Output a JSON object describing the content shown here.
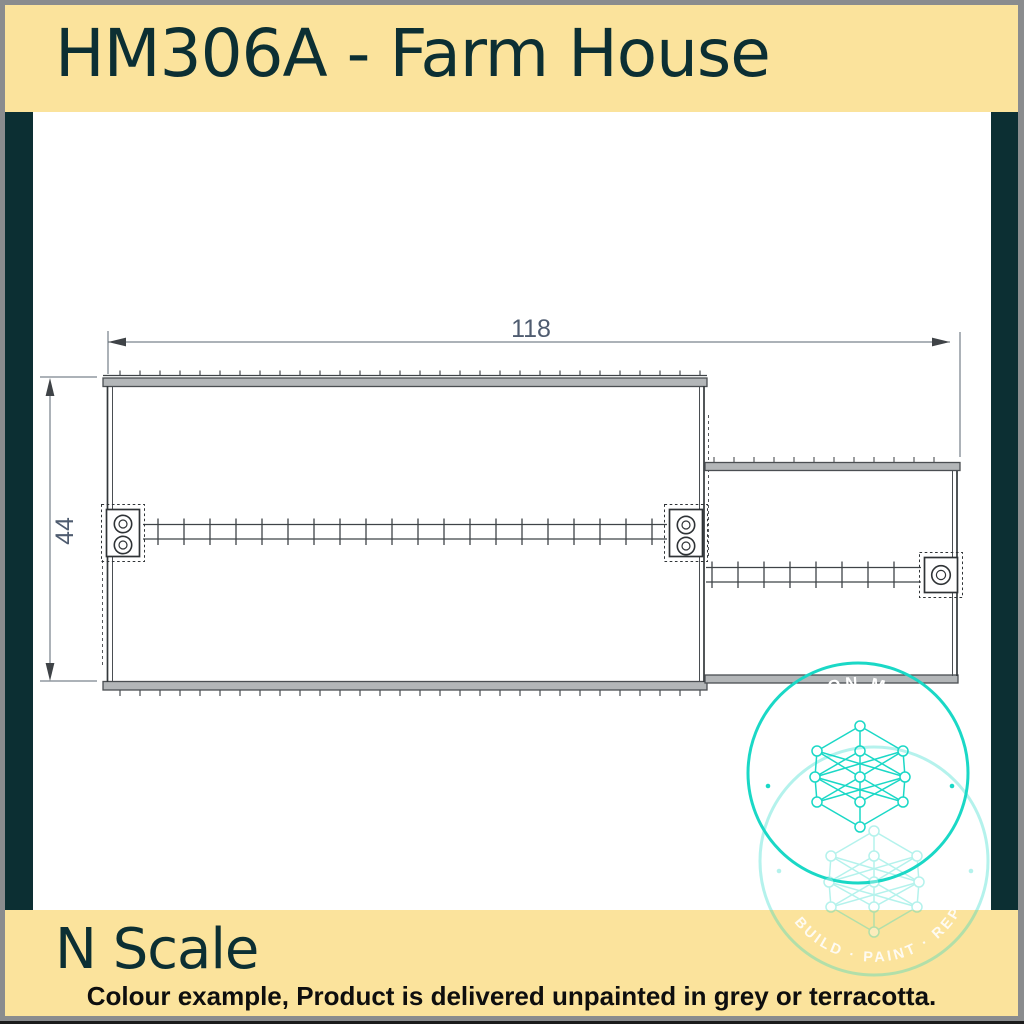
{
  "header": {
    "title": "HM306A - Farm House"
  },
  "footer": {
    "scale_label": "N Scale",
    "caption": "Colour example, Product is delivered unpainted in grey or terracotta."
  },
  "drawing": {
    "dim_width": "118",
    "dim_height": "44"
  },
  "watermark": {
    "arc_text_top": "ON M",
    "arc_text_bottom": "· BUILD · PAINT · REP"
  },
  "colors": {
    "banner_yellow": "#FBE39C",
    "accent_teal_dark": "#0C2F33",
    "frame_gray": "#8A8C8E",
    "watermark_teal": "#1AD8C6",
    "dimension_text": "#4F5C70",
    "drawing_line": "#3F4347",
    "caption_text": "#0E0E0E"
  }
}
